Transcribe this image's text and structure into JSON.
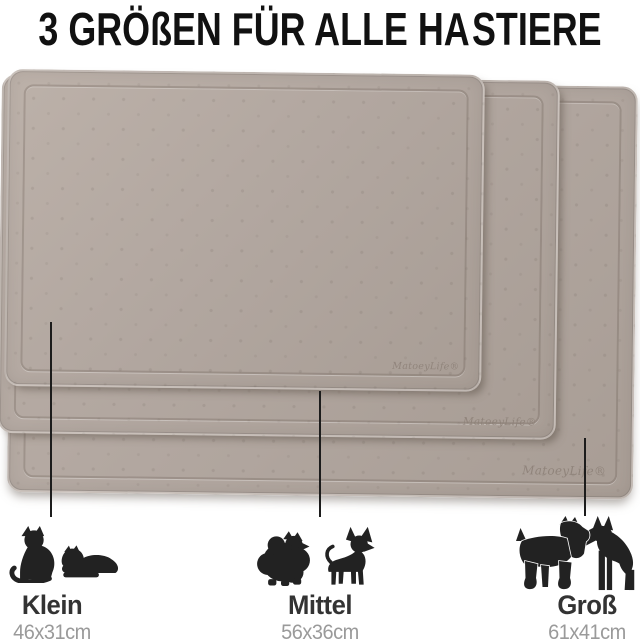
{
  "title": {
    "before": "3 GRÖßEN FÜR ALLE HA",
    "after": "STIERE",
    "paw_icon": "paw-print"
  },
  "brand": {
    "logo": "MatoeyLife®"
  },
  "mats": [
    {
      "id": "gross",
      "position": "back"
    },
    {
      "id": "mittel",
      "position": "middle"
    },
    {
      "id": "klein",
      "position": "front"
    }
  ],
  "legend": [
    {
      "label": "Klein",
      "size": "46x31cm",
      "animals": [
        "cat-sitting",
        "cat-lying"
      ]
    },
    {
      "label": "Mittel",
      "size": "56x36cm",
      "animals": [
        "dog-pomeranian",
        "dog-chihuahua"
      ]
    },
    {
      "label": "Groß",
      "size": "61x41cm",
      "animals": [
        "dog-schnauzer",
        "dog-doberman"
      ]
    }
  ],
  "colors": {
    "title_text": "#111111",
    "mat_base": "#b2a7a0",
    "mat_light": "#bcb1a9",
    "mat_dark": "#a89d95",
    "logo_text": "#8e8279",
    "silhouette": "#222222",
    "label_text": "#333333",
    "size_text": "#9a9a9a",
    "line_color": "#1c1c1c"
  }
}
